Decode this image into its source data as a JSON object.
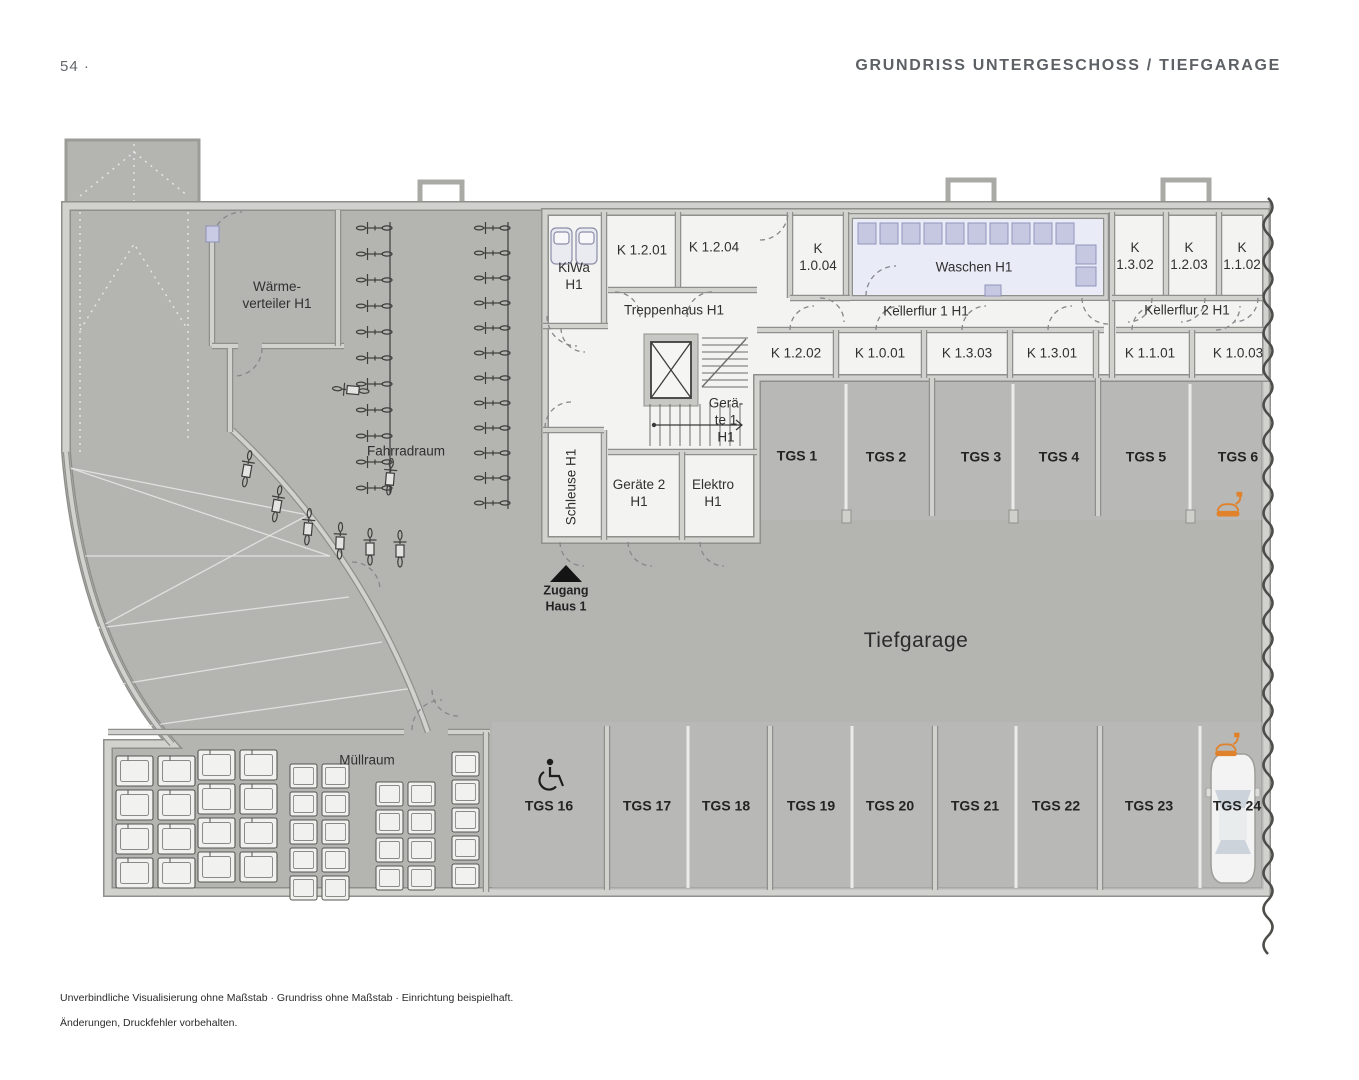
{
  "page": {
    "number": "54 ·",
    "title": "GRUNDRISS UNTERGESCHOSS / TIEFGARAGE"
  },
  "plan": {
    "rooms": {
      "waermeverteiler": "Wärme-\nverteiler H1",
      "fahrradraum": "Fahrradraum",
      "kiwa": "KiWa\nH1",
      "k1201": "K 1.2.01",
      "k1204": "K 1.2.04",
      "k1004": "K\n1.0.04",
      "waschen": "Waschen H1",
      "k1302": "K\n1.3.02",
      "k1203": "K\n1.2.03",
      "k1102": "K\n1.1.02",
      "treppenhaus": "Treppenhaus H1",
      "kellerflur1": "Kellerflur 1 H1",
      "kellerflur2": "Kellerflur 2 H1",
      "k1202": "K 1.2.02",
      "k1001": "K 1.0.01",
      "k1303": "K 1.3.03",
      "k1301": "K 1.3.01",
      "k1101": "K 1.1.01",
      "k1003": "K 1.0.03",
      "geraete1": "Gerä-\nte 1\nH1",
      "schleuse": "Schleuse H1",
      "geraete2": "Geräte 2\nH1",
      "elektro": "Elektro\nH1",
      "muellraum": "Müllraum",
      "tiefgarage": "Tiefgarage",
      "zugang": "Zugang\nHaus 1"
    },
    "parking_top": [
      "TGS 1",
      "TGS 2",
      "TGS 3",
      "TGS 4",
      "TGS 5",
      "TGS 6"
    ],
    "parking_bottom": [
      "TGS 16",
      "TGS 17",
      "TGS 18",
      "TGS 19",
      "TGS 20",
      "TGS 21",
      "TGS 22",
      "TGS 23",
      "TGS 24"
    ],
    "icons": {
      "entrance_triangle": "▲",
      "wheelchair": "♿ accessible parking spot",
      "ev_charging": "orange car-with-plug charging symbol",
      "car": "white car top view in TGS 24",
      "elevator": "square with X",
      "stairs": "hatched stair runs",
      "washing_machines": "row of lavender machine squares",
      "bicycles": "bike rack rows",
      "trash_bins": "bin grid in Müllraum"
    },
    "colors": {
      "garage_floor": "#b4b4b1",
      "stall_floor": "#bcbcb9",
      "room_floor": "#f3f3f1",
      "waschen_floor": "#e9ecf7",
      "machine_fill": "#c6c8e2",
      "wall_light": "#d1d1ce",
      "wall_edge": "#8f8f8c",
      "accent_orange": "#e0822c",
      "heading_gray": "#5d6165",
      "marking_white": "#ebebe9"
    }
  },
  "footer": {
    "line1": "Unverbindliche Visualisierung ohne Maßstab · Grundriss ohne Maßstab · Einrichtung beispielhaft.",
    "line2": "Änderungen, Druckfehler vorbehalten."
  }
}
